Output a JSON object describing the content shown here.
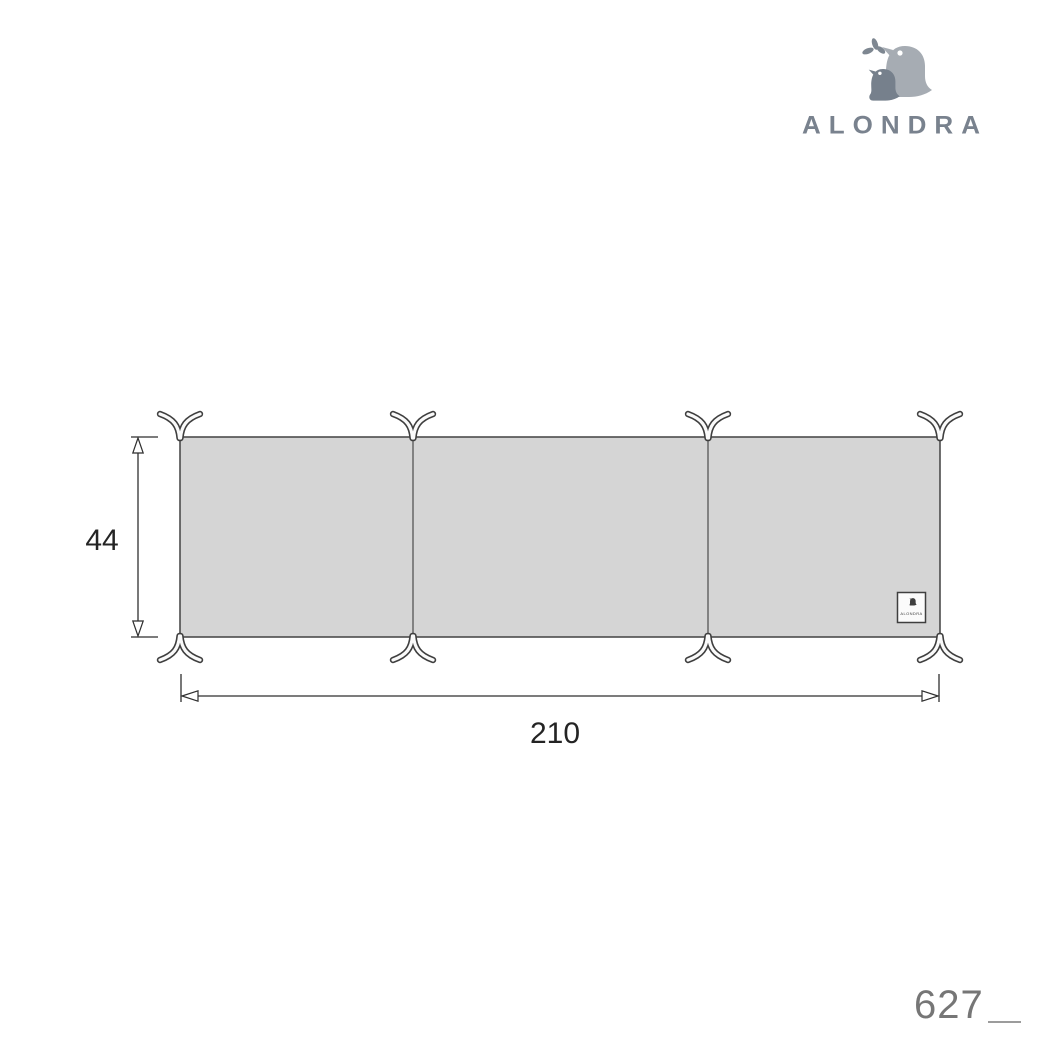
{
  "logo": {
    "brand": "ALONDRA"
  },
  "colors": {
    "background": "#FFFFFF",
    "panel_fill": "#D5D5D5",
    "panel_outline": "#4C4C4C",
    "dimension_lines": "#2F2F2F",
    "logo_text": "#79828E",
    "logo_bird_large": "#A6ACB3",
    "logo_bird_small": "#76808C",
    "reference_number": "#767676"
  },
  "diagram": {
    "height_label": "44",
    "width_label": "210",
    "panel_count": 3,
    "tie_pair_count": 8,
    "tag_text": "ALONDRA"
  },
  "footer": {
    "reference_number": "627"
  }
}
